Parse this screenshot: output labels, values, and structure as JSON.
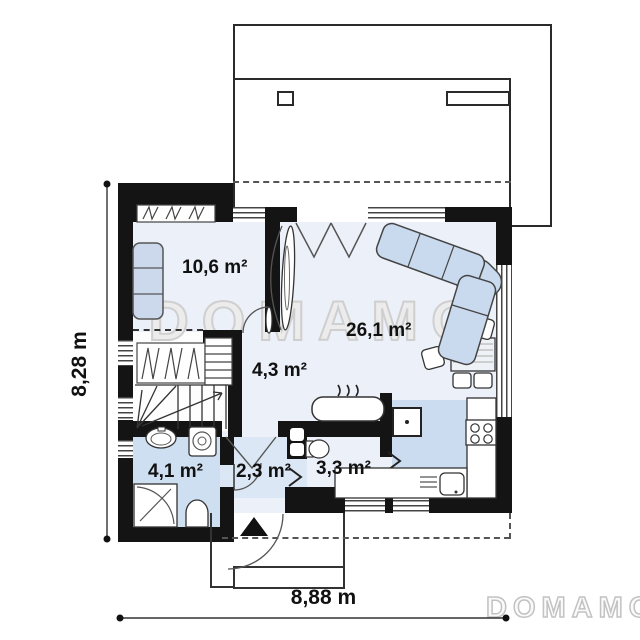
{
  "plan": {
    "type": "floor-plan",
    "watermark": {
      "center_text": "DOMAMO",
      "logo_text": "DOMAMO"
    },
    "rooms": [
      {
        "id": "bedroom",
        "area": "10,6 m²"
      },
      {
        "id": "living-room",
        "area": "26,1 m²"
      },
      {
        "id": "hall-stairs",
        "area": "4,3 m²"
      },
      {
        "id": "bathroom",
        "area": "4,1 m²"
      },
      {
        "id": "entrance-hall",
        "area": "2,3 m²"
      },
      {
        "id": "utility-room",
        "area": "3,3 m²"
      }
    ],
    "dimensions": {
      "overall_depth": "8,28 m",
      "overall_width": "8,88 m"
    },
    "colors": {
      "wall": "#141414",
      "floor": "#ecf0f9",
      "bathroom_floor": "#cfdff2",
      "entrance_floor": "#dbe7f5",
      "kitchen_floor": "#cbdcf0",
      "furniture_blue": "#c9daee",
      "watermark_gray": "#cfcfcf"
    }
  }
}
